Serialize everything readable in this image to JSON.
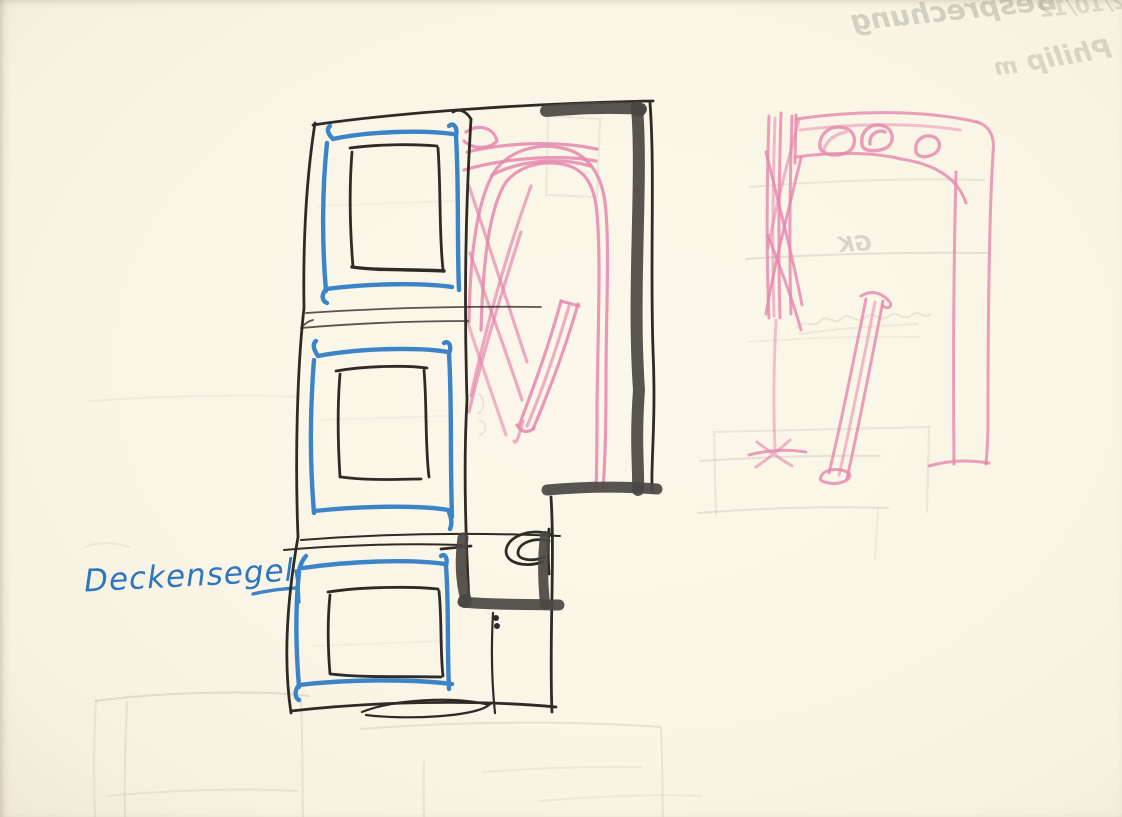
{
  "canvas": {
    "width_px": 1122,
    "height_px": 817,
    "paper_color": "#faf5e6"
  },
  "labels": {
    "deckensegel": "Deckensegel"
  },
  "bleedthrough": {
    "besprechung": "Besprechung",
    "date": "2/10/12",
    "mit_abbrev": "m",
    "philip": "Philip",
    "gk": "GK"
  },
  "colors": {
    "ink_black": "#2e2b27",
    "marker_dark": "#4a4643",
    "marker_blue": "#3c84c8",
    "pencil_pink": "#e687ae",
    "pencil_pink_dark": "#d96a9c",
    "graphite_faint": "#a9a79a",
    "label_blue": "#2f76c0"
  }
}
